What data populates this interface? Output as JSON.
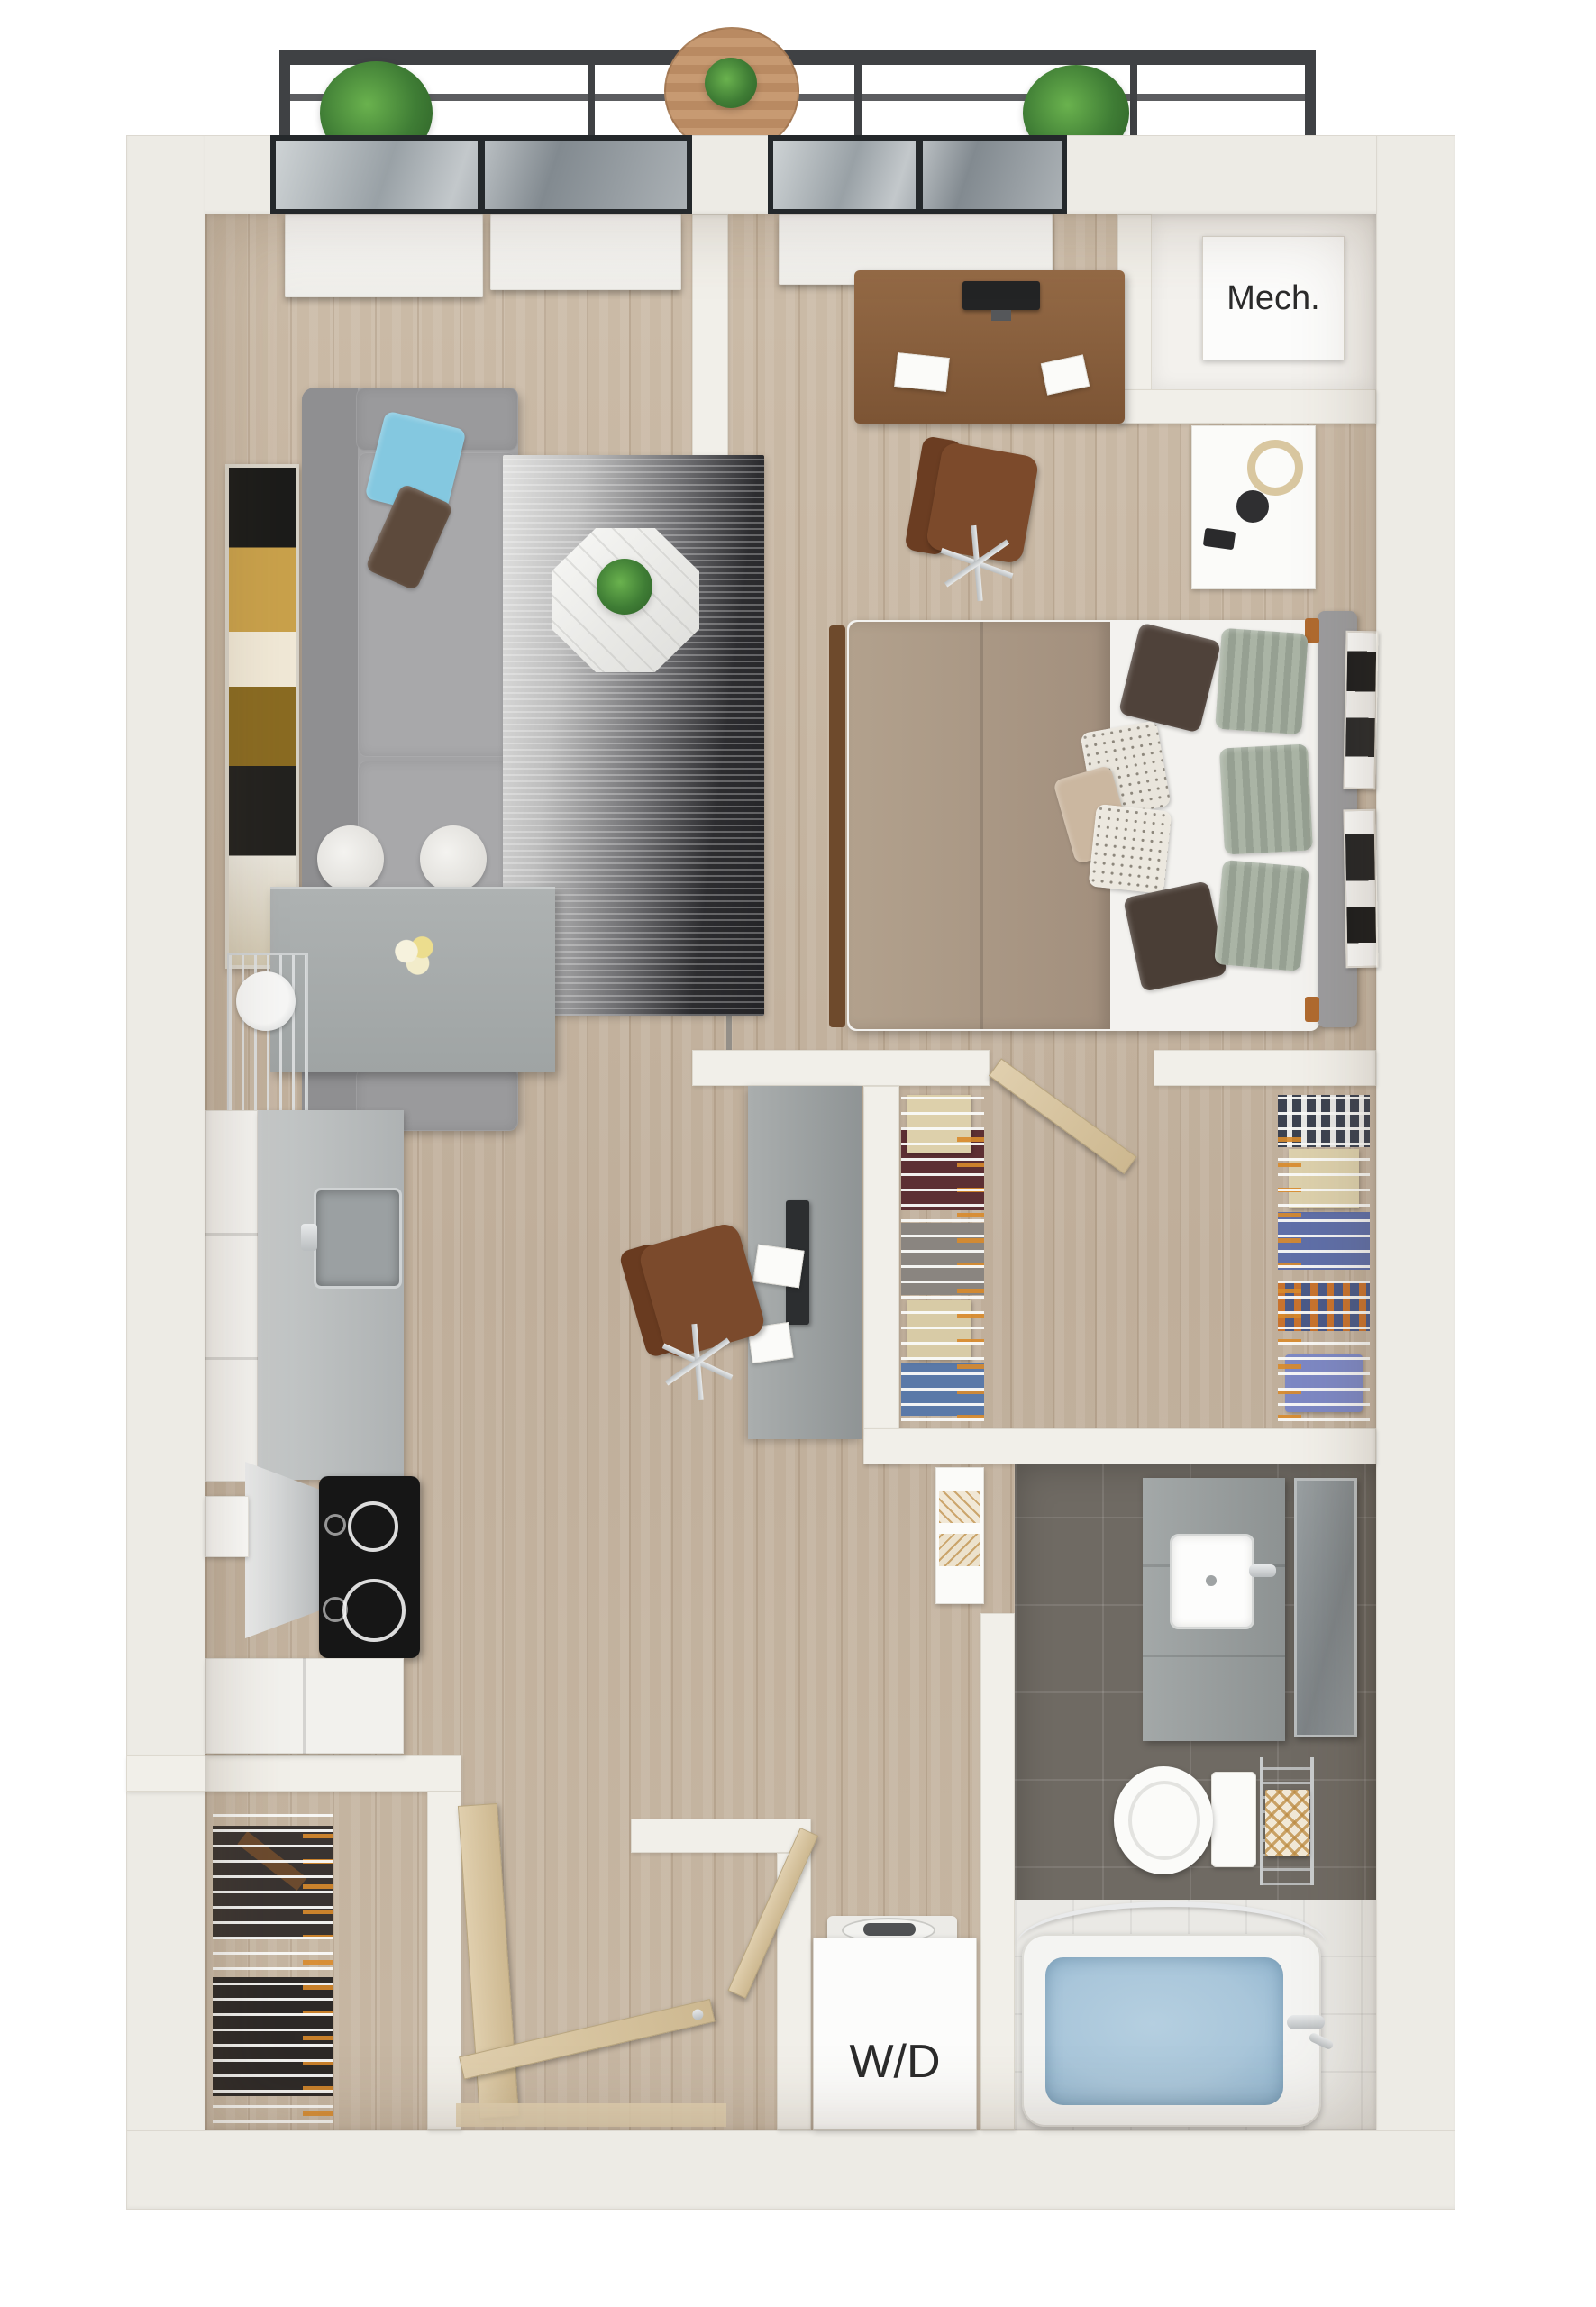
{
  "labels": {
    "mech_room": "Mech.",
    "washer_dryer": "W/D"
  },
  "palette": {
    "background": "#ffffff",
    "outer_wall": "#edebe5",
    "interior_wall": "#f1efe9",
    "wood_floor": "#c4b3a0",
    "bathroom_tile": "#6f6a63",
    "tub_water": "#a9c6da",
    "sofa_gray": "#a3a3a5",
    "accent_pillow_blue": "#84c8e0",
    "rug_dark_end": "#232326",
    "counter_gray": "#a7acac",
    "bed_taupe": "#ab9a87",
    "door_wood": "#d9c6a6",
    "railing_dark": "#3f4144",
    "plant_green": "#4c8f3c",
    "desk_wood_brown": "#8a5f3e",
    "chair_leather_brown": "#7b4a2c",
    "glass_frame": "#24282b"
  },
  "rooms": [
    {
      "id": "balcony",
      "furniture": [
        "planter-left",
        "round-table",
        "planter-right",
        "railing"
      ]
    },
    {
      "id": "living-room",
      "furniture": [
        "sofa",
        "blue-accent-pillows",
        "brown-pillow",
        "gradient-area-rug",
        "octagon-marble-coffee-table",
        "potted-plant",
        "wall-art",
        "glass-doors",
        "roller-shades"
      ]
    },
    {
      "id": "bedroom",
      "furniture": [
        "desk",
        "monitor",
        "office-chair",
        "bed",
        "pillows",
        "nightstand",
        "ring-lamp",
        "wall-art-frames",
        "roller-shade",
        "sliding-door"
      ]
    },
    {
      "id": "mech-room",
      "label": "Mech."
    },
    {
      "id": "kitchen",
      "furniture": [
        "peninsula-counter",
        "bar-stools",
        "flower-vase",
        "wire-wall-shelf",
        "stainless-sink",
        "range-hood",
        "black-cooktop",
        "white-cabinets",
        "refrigerator"
      ]
    },
    {
      "id": "work-nook",
      "furniture": [
        "built-in-desk",
        "monitor",
        "office-chair",
        "papers"
      ]
    },
    {
      "id": "walk-in-closet",
      "furniture": [
        "wire-shelving-left",
        "wire-shelving-right",
        "hanging-clothes",
        "storage-boxes",
        "swing-door"
      ]
    },
    {
      "id": "bathroom",
      "furniture": [
        "vanity",
        "sink",
        "leaning-mirror",
        "toilet",
        "towel-rack",
        "bathtub",
        "curved-shower-rod",
        "linen-shelf"
      ]
    },
    {
      "id": "laundry-closet",
      "label": "W/D",
      "furniture": [
        "washer-dryer-unit"
      ]
    },
    {
      "id": "coat-closet",
      "furniture": [
        "wire-shelving",
        "hanging-clothes",
        "swing-door"
      ]
    },
    {
      "id": "entry",
      "furniture": [
        "entry-door",
        "threshold"
      ]
    }
  ]
}
